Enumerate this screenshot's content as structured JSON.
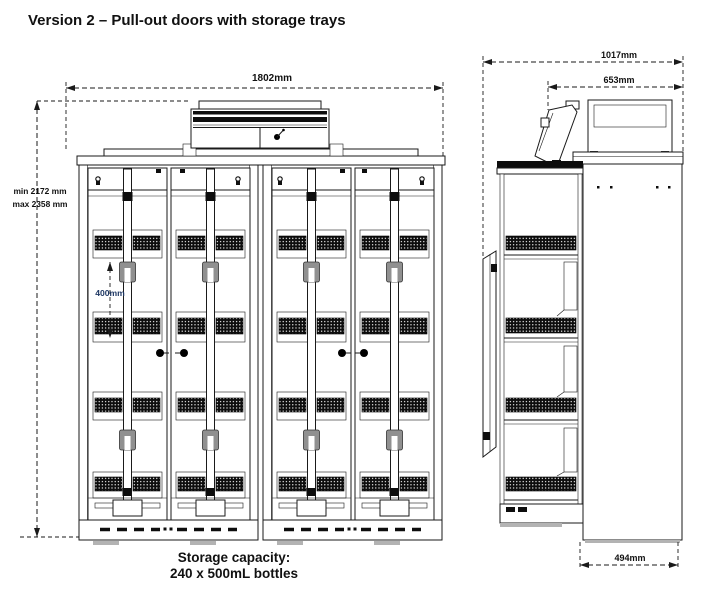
{
  "title": "Version 2 – Pull-out doors with storage trays",
  "front_view": {
    "name": "front-elevation",
    "width_label": "1802mm",
    "height_min_label": "min 2172 mm",
    "height_max_label": "max 2358 mm",
    "tray_pitch_label": "400mm"
  },
  "side_view": {
    "name": "side-elevation",
    "overall_depth_label": "1017mm",
    "top_unit_depth_label": "653mm",
    "base_depth_label": "494mm"
  },
  "caption": {
    "line1": "Storage capacity:",
    "line2": "240 x 500mL bottles"
  },
  "colors": {
    "line": "#1a1a1a",
    "dimension_text": "#111111",
    "tray_pitch_text": "#1f3864",
    "background": "#ffffff"
  }
}
